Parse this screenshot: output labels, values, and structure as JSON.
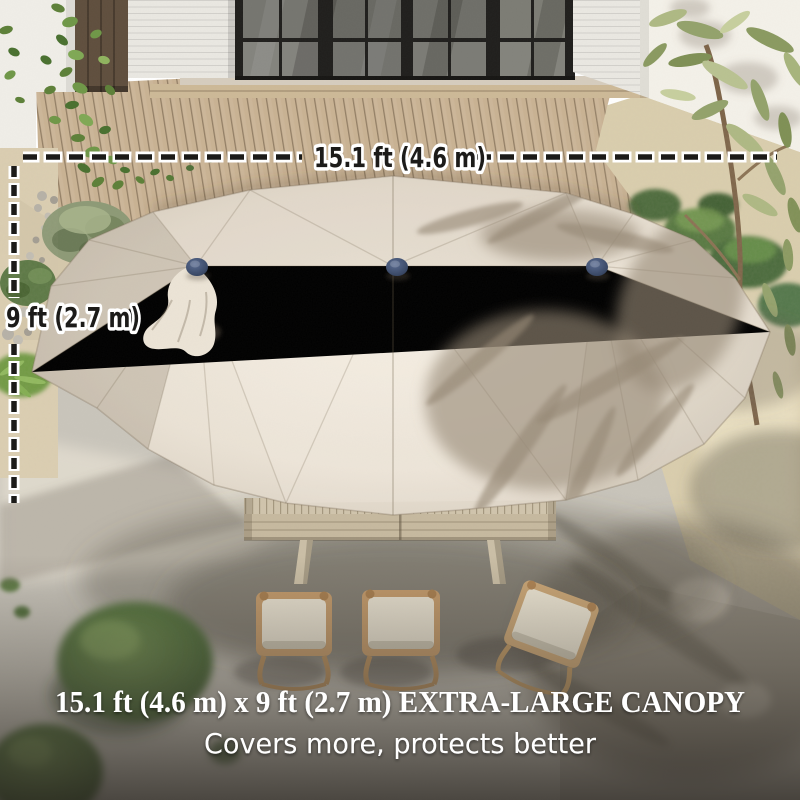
{
  "annotations": {
    "width_label": "15.1 ft (4.6 m)",
    "height_label": "9 ft (2.7 m)"
  },
  "caption": {
    "headline": "15.1 ft (4.6 m) x 9 ft (2.7 m) EXTRA-LARGE CANOPY",
    "subheadline": "Covers more, protects better"
  },
  "style": {
    "annotation_text_color": "#1c1b19",
    "annotation_halo_color": "#ffffff",
    "caption_text_color": "#ffffff",
    "canopy_color": "#e6ddcf",
    "finial_color": "#3c4c66"
  },
  "scene": {
    "canopy_finials": 3,
    "chairs": 3
  }
}
